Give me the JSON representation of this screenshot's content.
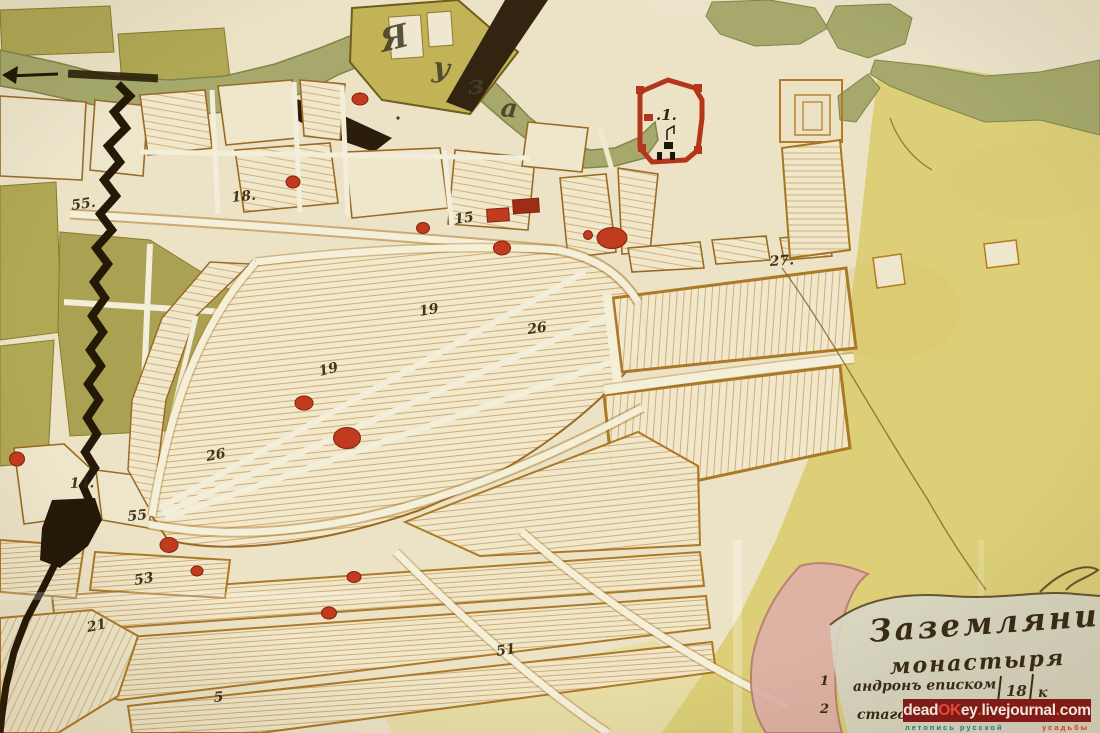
{
  "palette": {
    "paper": "#ece3c6",
    "paper_light": "#f3edd8",
    "yellow_field": "#dccf78",
    "olive_green": "#b0a855",
    "river_green": "#a6a96b",
    "khaki_building": "#c2b356",
    "outline_brown": "#9a6a26",
    "hatch_brown": "#b5823d",
    "ink": "#33270f",
    "building_red": "#c23b1e",
    "building_dark_red": "#9e2d13",
    "rampart_black": "#241806",
    "pink_band": "#e0b1a9",
    "cartouche_wash": "#d8d6c8",
    "watermark_bg": "#7d1512",
    "watermark_text": "#f2e8da",
    "watermark_accent": "#e8432e",
    "tagline_teal": "#23777c",
    "tagline_red": "#cf3a28"
  },
  "river": {
    "letters": [
      {
        "ch": "Я"
      },
      {
        "ch": "у"
      },
      {
        "ch": "з"
      },
      {
        "ch": "а"
      }
    ]
  },
  "monastery": {
    "label": ".1."
  },
  "map": {
    "numbers": [
      {
        "label": "55.",
        "x": 72,
        "y": 210,
        "rot": -8
      },
      {
        "label": "18.",
        "x": 232,
        "y": 202,
        "rot": -6
      },
      {
        "label": "15",
        "x": 455,
        "y": 224,
        "rot": -8
      },
      {
        "label": "19",
        "x": 420,
        "y": 316,
        "rot": -10
      },
      {
        "label": "19",
        "x": 320,
        "y": 376,
        "rot": -14
      },
      {
        "label": "26",
        "x": 528,
        "y": 334,
        "rot": -8
      },
      {
        "label": "27.",
        "x": 770,
        "y": 266,
        "rot": -4
      },
      {
        "label": "26",
        "x": 207,
        "y": 461,
        "rot": -10
      },
      {
        "label": "14.",
        "x": 70,
        "y": 488,
        "rot": -2
      },
      {
        "label": "55",
        "x": 128,
        "y": 521,
        "rot": -6
      },
      {
        "label": "53",
        "x": 135,
        "y": 585,
        "rot": -10
      },
      {
        "label": "21",
        "x": 88,
        "y": 632,
        "rot": -12
      },
      {
        "label": "51",
        "x": 497,
        "y": 656,
        "rot": -9
      },
      {
        "label": "5",
        "x": 214,
        "y": 702,
        "rot": -4
      }
    ],
    "buildings": [
      {
        "x": 360,
        "y": 99,
        "w": 16,
        "h": 12,
        "shape": "blob"
      },
      {
        "x": 293,
        "y": 182,
        "w": 14,
        "h": 12,
        "shape": "blob"
      },
      {
        "x": 498,
        "y": 215,
        "w": 22,
        "h": 13,
        "shape": "rect",
        "rot": -4
      },
      {
        "x": 526,
        "y": 206,
        "w": 26,
        "h": 14,
        "shape": "rect",
        "rot": -4,
        "color": "#9e2d13"
      },
      {
        "x": 423,
        "y": 228,
        "w": 13,
        "h": 11,
        "shape": "blob"
      },
      {
        "x": 502,
        "y": 248,
        "w": 17,
        "h": 14,
        "shape": "blob"
      },
      {
        "x": 588,
        "y": 235,
        "w": 9,
        "h": 9,
        "shape": "blob"
      },
      {
        "x": 612,
        "y": 238,
        "w": 30,
        "h": 21,
        "shape": "blob"
      },
      {
        "x": 304,
        "y": 403,
        "w": 18,
        "h": 14,
        "shape": "blob"
      },
      {
        "x": 347,
        "y": 438,
        "w": 27,
        "h": 21,
        "shape": "blob"
      },
      {
        "x": 169,
        "y": 545,
        "w": 18,
        "h": 15,
        "shape": "blob"
      },
      {
        "x": 17,
        "y": 459,
        "w": 15,
        "h": 14,
        "shape": "blob"
      },
      {
        "x": 197,
        "y": 571,
        "w": 12,
        "h": 10,
        "shape": "blob"
      },
      {
        "x": 354,
        "y": 577,
        "w": 14,
        "h": 11,
        "shape": "blob"
      },
      {
        "x": 329,
        "y": 613,
        "w": 15,
        "h": 12,
        "shape": "blob"
      }
    ]
  },
  "cartouche": {
    "line1": "Заземлянимъ",
    "line2": "монастыря",
    "entries": [
      {
        "index": "1",
        "text": "андронъ еписком",
        "value": "18",
        "suffix": "к"
      },
      {
        "index": "2",
        "text": "стаго",
        "value": "",
        "suffix": ""
      }
    ]
  },
  "watermark": {
    "p1": "dead",
    "p2": "OK",
    "p3": "ey",
    "d1": ".",
    "p4": "livejournal",
    "d2": ".",
    "p5": "com",
    "tagline_left": "летопись русской",
    "tagline_right": "усадьбы"
  }
}
